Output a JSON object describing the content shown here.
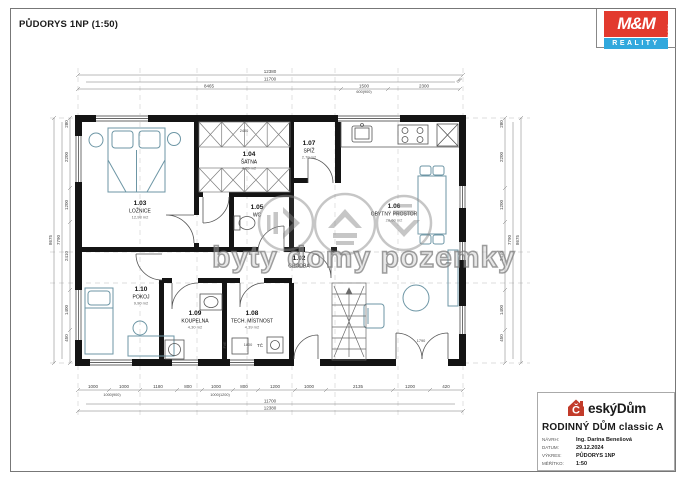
{
  "sheet": {
    "title": "PŮDORYS 1NP (1:50)"
  },
  "mm_logo": {
    "name": "M&M",
    "sub": "REALITY",
    "side": "HOLDING"
  },
  "watermark": {
    "text": "byty domy pozemky"
  },
  "rooms": [
    {
      "id": "1.03",
      "name": "LOŽNICE",
      "area": "12,98 m2"
    },
    {
      "id": "1.04",
      "name": "ŠATNA",
      "area": "4,09 m2"
    },
    {
      "id": "1.05",
      "name": "WC",
      "area": ""
    },
    {
      "id": "1.07",
      "name": "SPÍŽ",
      "area": "2,70 m2"
    },
    {
      "id": "1.06",
      "name": "OBYTNÝ PROSTOR",
      "area": "28,60 m2"
    },
    {
      "id": "1.02",
      "name": "CHODBA",
      "area": ""
    },
    {
      "id": "1.10",
      "name": "POKOJ",
      "area": "9,90 m2"
    },
    {
      "id": "1.09",
      "name": "KOUPELNA",
      "area": "4,30 m2"
    },
    {
      "id": "1.08",
      "name": "TECH. MÍSTNOST",
      "area": "4,39 m2"
    }
  ],
  "labels": {
    "tc": "TČ",
    "fve": "FVE"
  },
  "dims": {
    "top_total": "12380",
    "top_inner": "11700",
    "top_left": "8465",
    "top_win": "1500",
    "top_win_sub": "600(900)",
    "top_right": "2300",
    "top_edge": "280",
    "bottom_segs": [
      "1000",
      "1000",
      "1180",
      "800",
      "1000",
      "800",
      "1200",
      "1000",
      "2135",
      "1200",
      "420"
    ],
    "bottom_sub": [
      "1000(900)",
      "1000(1200)"
    ],
    "bottom_inner": "11700",
    "bottom_total": "12380",
    "right_segs": [
      "280",
      "2200",
      "1200",
      "2410",
      "1400",
      "450"
    ],
    "right_inner": "7790",
    "right_total": "8675",
    "left_segs": [
      "450",
      "1400",
      "2410",
      "1200",
      "2200",
      "280"
    ],
    "left_inner": "7790",
    "left_total": "8675",
    "misc_satna": "2400",
    "misc_stairs": "1800",
    "misc_door": "1790"
  },
  "titleblock": {
    "brand_icon_letter": "Č",
    "brand_rest": "eskýDům",
    "project": "RODINNÝ DŮM classic A",
    "rows": [
      {
        "label": "NÁVRH:",
        "value": "Ing. Darina Benešová"
      },
      {
        "label": "DATUM:",
        "value": "29.12.2024"
      },
      {
        "label": "VÝKRES:",
        "value": "PŮDORYS 1NP"
      },
      {
        "label": "MĚŘÍTKO:",
        "value": "1:50"
      }
    ]
  }
}
